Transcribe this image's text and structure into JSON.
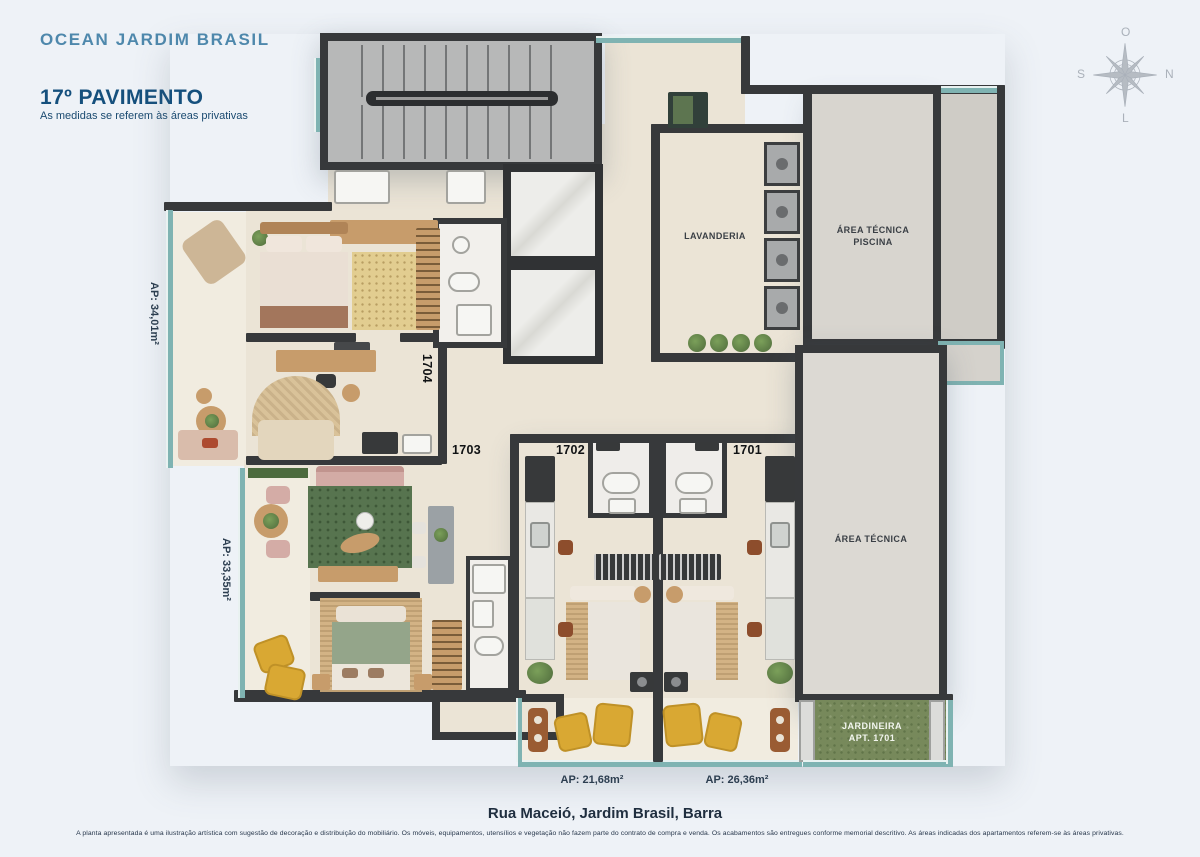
{
  "header": {
    "project": "OCEAN JARDIM BRASIL",
    "floor": "17º PAVIMENTO",
    "note": "As medidas se referem às áreas privativas"
  },
  "compass": {
    "west": "O",
    "north": "N",
    "south": "S",
    "east": "L"
  },
  "plan": {
    "labels": {
      "lavanderia": "LAVANDERIA",
      "area_tecnica_piscina_line1": "ÁREA TÉCNICA",
      "area_tecnica_piscina_line2": "PISCINA",
      "area_tecnica": "ÁREA TÉCNICA",
      "jardineira_line1": "JARDINEIRA",
      "jardineira_line2": "APT. 1701"
    },
    "units": {
      "u1704": {
        "number": "1704",
        "area": "AP: 34,01m²"
      },
      "u1703": {
        "number": "1703",
        "area": "AP: 33,35m²"
      },
      "u1702": {
        "number": "1702",
        "area": "AP: 21,68m²"
      },
      "u1701": {
        "number": "1701",
        "area": "AP: 26,36m²"
      }
    }
  },
  "footer": {
    "address": "Rua Maceió, Jardim Brasil, Barra",
    "disclaimer": "A planta apresentada é uma ilustração artística com sugestão de decoração e distribuição do mobiliário. Os móveis, equipamentos, utensílios e vegetação não fazem parte do contrato de compra e venda. Os acabamentos são entregues conforme memorial descritivo. As áreas indicadas dos apartamentos referem-se às áreas privativas."
  },
  "colors": {
    "background": "#eef2f7",
    "wall": "#37393b",
    "floor": "#ebe4d6",
    "concrete": "#d8d5cf",
    "glass_teal": "#7fb3b2",
    "grass_green": "#77895b",
    "brand_blue": "#4e88ac",
    "deep_blue": "#15507d"
  }
}
